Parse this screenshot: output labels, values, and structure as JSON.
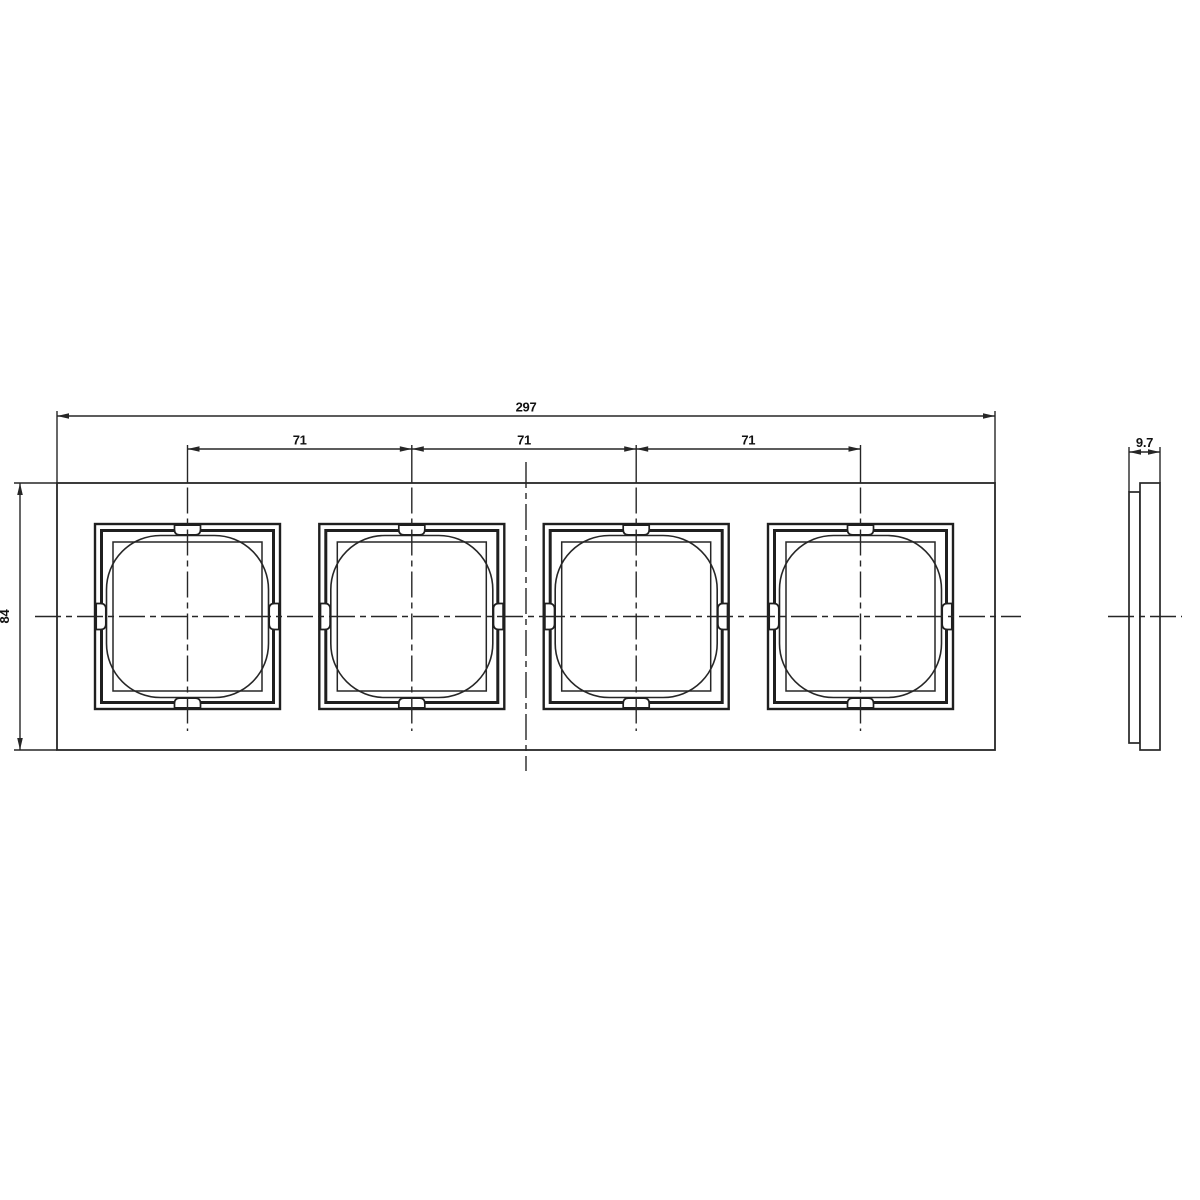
{
  "drawing": {
    "labels": {
      "overall_width": "297",
      "pitch_left": "71",
      "pitch_center": "71",
      "pitch_right": "71",
      "overall_height": "84",
      "thickness": "9.7"
    },
    "colors": {
      "background": "#ffffff",
      "line": "#262626",
      "text": "#111111"
    }
  }
}
